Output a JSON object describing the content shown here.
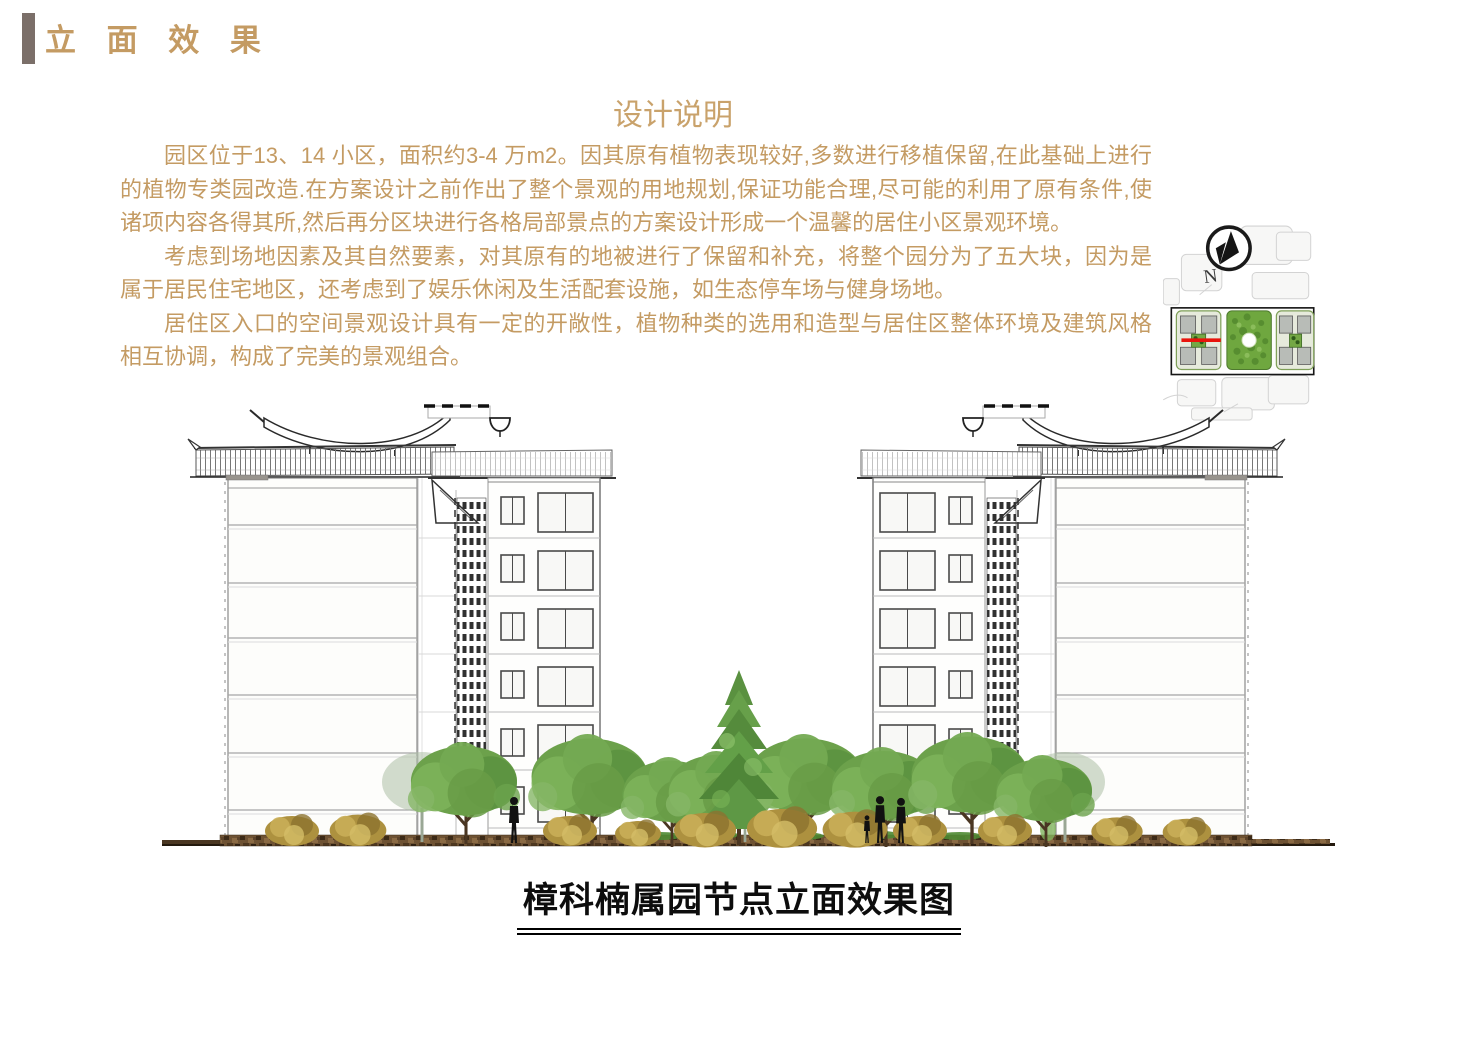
{
  "header": {
    "title": "立 面 效 果"
  },
  "description": {
    "heading": "设计说明",
    "paragraphs": [
      "园区位于13、14 小区，面积约3-4 万m2。因其原有植物表现较好,多数进行移植保留,在此基础上进行的植物专类园改造.在方案设计之前作出了整个景观的用地规划,保证功能合理,尽可能的利用了原有条件,使诸项内容各得其所,然后再分区块进行各格局部景点的方案设计形成一个温馨的居住小区景观环境。",
      "考虑到场地因素及其自然要素，对其原有的地被进行了保留和补充，将整个园分为了五大块，因为是属于居民住宅地区，还考虑到了娱乐休闲及生活配套设施，如生态停车场与健身场地。",
      "居住区入口的空间景观设计具有一定的开敞性，植物种类的选用和造型与居住区整体环境及建筑风格相互协调，构成了完美的景观组合。"
    ]
  },
  "map": {
    "north_label": "N"
  },
  "drawing": {
    "caption": "樟科楠属园节点立面效果图"
  },
  "colors": {
    "accent_tan": "#C49B63",
    "title_bar_gray": "#7B6F69",
    "caption_black": "#0D0D0D",
    "section_line_red": "#E8140C",
    "map_green": "#6FA73F",
    "ground_brown": "#6E5233",
    "tree_green": "#6CA14B",
    "shrub_gold": "#AD913F"
  }
}
